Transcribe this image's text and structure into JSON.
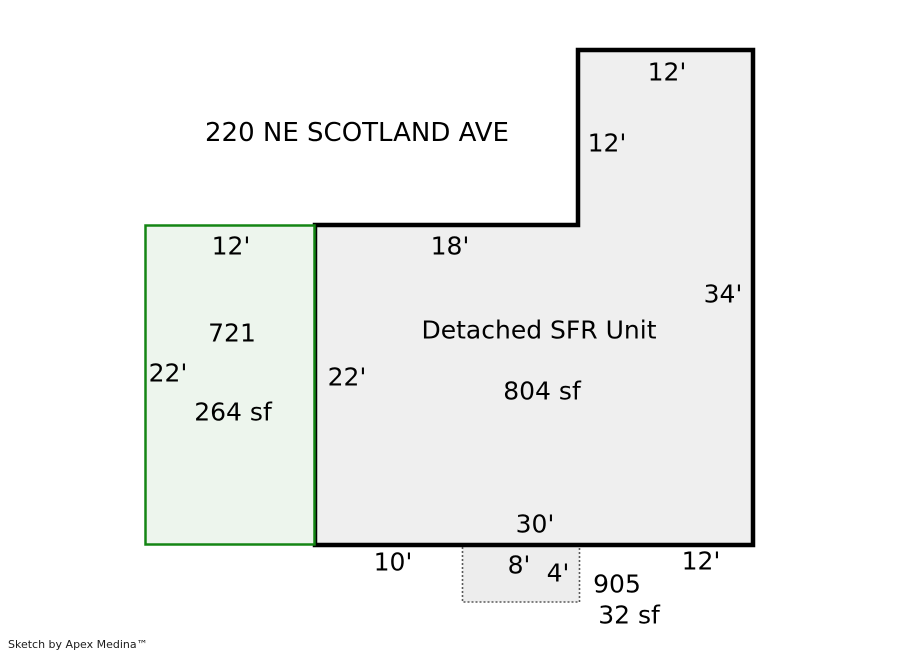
{
  "header": {
    "address": "220 NE SCOTLAND AVE"
  },
  "footer": {
    "credit": "Sketch by Apex Medina™"
  },
  "colors": {
    "main_fill": "#efefef",
    "main_stroke": "#000000",
    "addition_fill": "#edf5ed",
    "addition_stroke": "#148514",
    "patio_fill": "#ededed",
    "patio_stroke": "#595959",
    "text": "#000000"
  },
  "areas": {
    "main": {
      "label": "Detached SFR Unit",
      "area": "804 sf",
      "dim_tower_top": "12'",
      "dim_tower_left": "12'",
      "dim_top_left": "18'",
      "dim_right": "34'",
      "dim_left": "22'",
      "dim_bottom": "30'",
      "dim_bottom_left": "10'",
      "dim_bottom_right": "12'"
    },
    "addition": {
      "code": "721",
      "area": "264 sf",
      "dim_top": "12'",
      "dim_left": "22'"
    },
    "patio": {
      "code": "905",
      "area": "32 sf",
      "dim_width": "8'",
      "dim_height": "4'"
    }
  }
}
